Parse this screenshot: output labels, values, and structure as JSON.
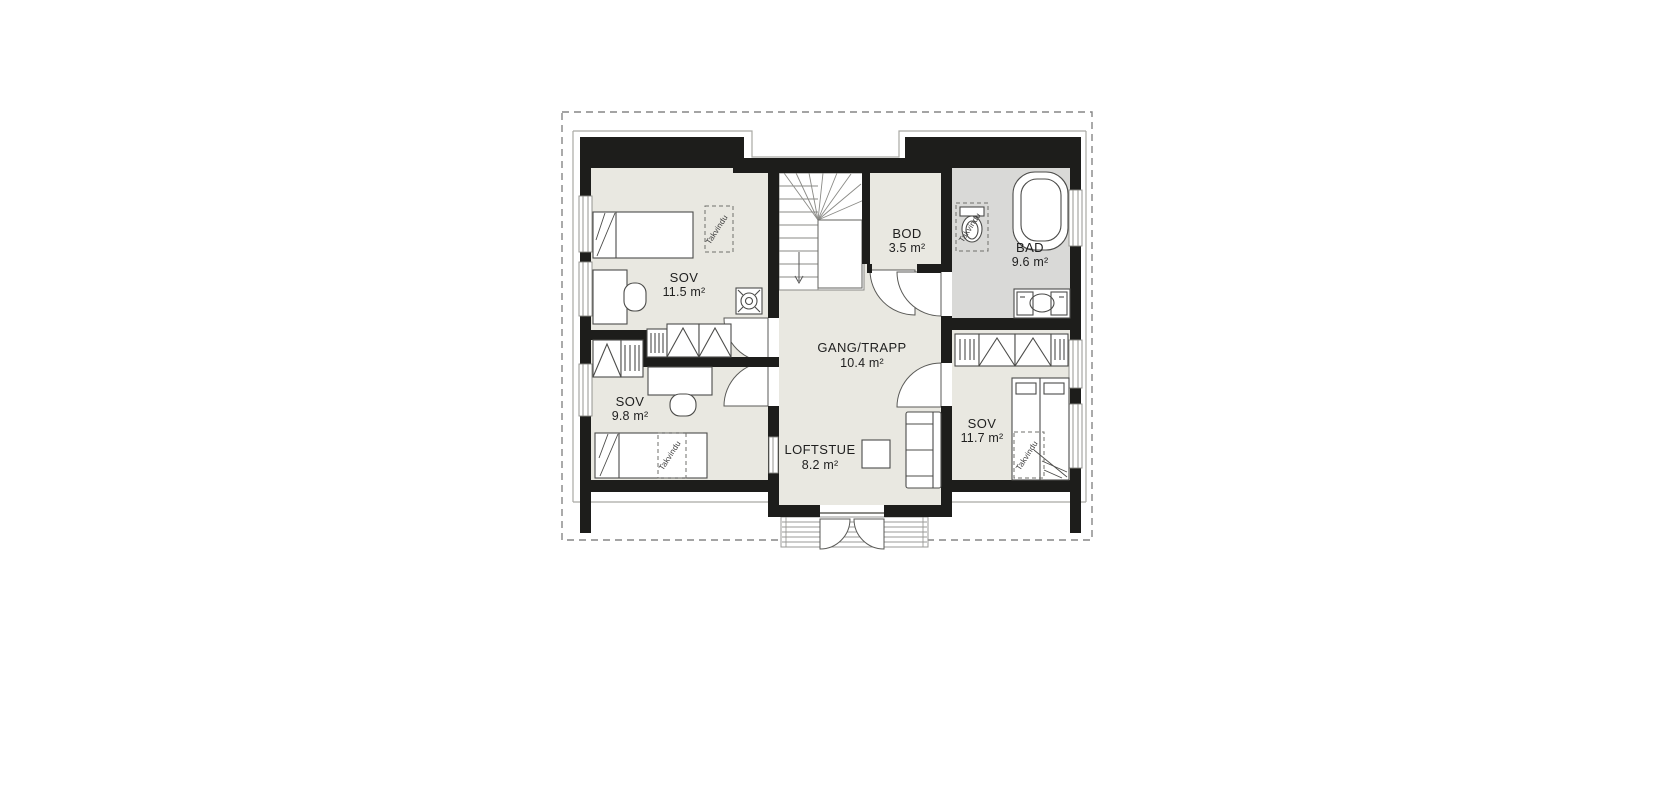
{
  "floorplan": {
    "rooms": [
      {
        "name": "SOV",
        "area": "11.5 m²"
      },
      {
        "name": "SOV",
        "area": "9.8 m²"
      },
      {
        "name": "BOD",
        "area": "3.5 m²"
      },
      {
        "name": "BAD",
        "area": "9.6 m²"
      },
      {
        "name": "GANG/TRAPP",
        "area": "10.4 m²"
      },
      {
        "name": "SOV",
        "area": "11.7 m²"
      },
      {
        "name": "LOFTSTUE",
        "area": "8.2 m²"
      }
    ],
    "skylight_label": "Takvindu",
    "colors": {
      "wall": "#1d1d1b",
      "floor": "#e9e8e1",
      "bathroom_floor": "#d9d9d7",
      "outline": "#a9a9a4",
      "furniture_stroke": "#4c4c4a",
      "background": "#ffffff"
    }
  }
}
